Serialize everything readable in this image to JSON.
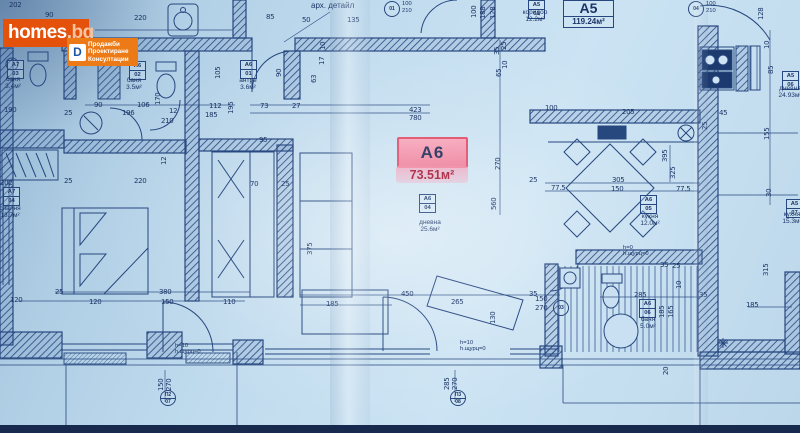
{
  "watermark": {
    "brand": "homes",
    "brand_suffix": ".bg",
    "emblem_letter": "D",
    "tagline_lines": [
      "Продажби",
      "Проектиране",
      "Консултации"
    ],
    "colors": {
      "brand_bg": "#e3510b",
      "tagline_bg": "#ec7b17",
      "text": "#ffffff",
      "suffix": "#f8c49f",
      "emblem_blue": "#1d56a8"
    }
  },
  "unit_a6": {
    "code": "А6",
    "area": "73.51м²",
    "highlight_bg": "#ee86a1",
    "highlight_border": "#e25672"
  },
  "unit_a5": {
    "code": "А5",
    "area": "119.24м²"
  },
  "plan": {
    "ink_color": "#27477f",
    "paper_color": "#c0dbee",
    "room_labels": [
      {
        "r1": "А7",
        "r2": "03",
        "bx": 7,
        "by": 60,
        "name": "баня",
        "area": "3.4м²",
        "tx": -4,
        "ty": 76,
        "tw": 34
      },
      {
        "r1": "А6",
        "r2": "02",
        "bx": 129,
        "by": 61,
        "name": "баня",
        "area": "3.5м²",
        "tx": 117,
        "ty": 77,
        "tw": 34
      },
      {
        "r1": "А6",
        "r2": "01",
        "bx": 240,
        "by": 60,
        "name": "антре",
        "area": "3.6м²",
        "tx": 229,
        "ty": 77,
        "tw": 38
      },
      {
        "r1": "А7",
        "r2": "04",
        "bx": 3,
        "by": 187,
        "name": "спалня",
        "area": "13.7м²",
        "tx": -8,
        "ty": 205,
        "tw": 36
      },
      {
        "r1": "А6",
        "r2": "04",
        "bx": 419,
        "by": 194,
        "name": "дневна",
        "area": "25.6м²",
        "tx": 408,
        "ty": 219,
        "tw": 44
      },
      {
        "r1": "А6",
        "r2": "05",
        "bx": 640,
        "by": 195,
        "name": "кухня",
        "area": "12.0м²",
        "tx": 628,
        "ty": 213,
        "tw": 44
      },
      {
        "r1": "А6",
        "r2": "06",
        "bx": 639,
        "by": 299,
        "name": "баня",
        "area": "5.0м²",
        "tx": 628,
        "ty": 316,
        "tw": 40
      },
      {
        "r1": "А5",
        "r2": "01",
        "bx": 528,
        "by": 0,
        "name": "коридор",
        "area": "12.2м²",
        "tx": 512,
        "ty": 9,
        "tw": 46
      },
      {
        "r1": "А5",
        "r2": "06",
        "bx": 782,
        "by": 71,
        "name": "дневна",
        "area": "24.93м²",
        "tx": 768,
        "ty": 85,
        "tw": 44
      },
      {
        "r1": "А5",
        "r2": "07",
        "bx": 786,
        "by": 199,
        "name": "кухня",
        "area": "15.3м²",
        "tx": 772,
        "ty": 211,
        "tw": 40
      }
    ],
    "notes": [
      {
        "lines": [
          "арх. детайл"
        ],
        "x": 311,
        "y": 3,
        "fs": 8
      },
      {
        "lines": [
          "h=10",
          "h.щурц=0"
        ],
        "x": 175,
        "y": 343
      },
      {
        "lines": [
          "h=10",
          "h.щурц=0"
        ],
        "x": 460,
        "y": 340
      },
      {
        "lines": [
          "h=0",
          "h.щурц=0"
        ],
        "x": 623,
        "y": 245
      }
    ],
    "markers": [
      {
        "c1": "01",
        "x": 384,
        "y": 1,
        "d1": "100",
        "d2": "210"
      },
      {
        "c1": "04",
        "x": 688,
        "y": 1,
        "d1": "100",
        "d2": "210"
      },
      {
        "c1": "П2",
        "c2": "07",
        "x": 160,
        "y": 390
      },
      {
        "c1": "П3",
        "c2": "08",
        "x": 450,
        "y": 390
      },
      {
        "c1": "03",
        "x": 553,
        "y": 300
      }
    ],
    "dims": [
      {
        "t": "202",
        "x": 9,
        "y": 1
      },
      {
        "t": "90",
        "x": 45,
        "y": 11
      },
      {
        "t": "220",
        "x": 134,
        "y": 14
      },
      {
        "t": "85",
        "x": 266,
        "y": 13
      },
      {
        "t": "50",
        "x": 302,
        "y": 16
      },
      {
        "t": "135",
        "x": 347,
        "y": 16
      },
      {
        "t": "100",
        "x": 470,
        "y": 1,
        "v": 1
      },
      {
        "t": "188",
        "x": 479,
        "y": 2,
        "v": 1
      },
      {
        "t": "128",
        "x": 489,
        "y": 2,
        "v": 1
      },
      {
        "t": "128",
        "x": 757,
        "y": 3,
        "v": 1
      },
      {
        "t": "190",
        "x": 4,
        "y": 106
      },
      {
        "t": "25",
        "x": 64,
        "y": 109
      },
      {
        "t": "90",
        "x": 94,
        "y": 101
      },
      {
        "t": "106",
        "x": 137,
        "y": 101
      },
      {
        "t": "196",
        "x": 122,
        "y": 109
      },
      {
        "t": "12",
        "x": 169,
        "y": 107
      },
      {
        "t": "210",
        "x": 161,
        "y": 117
      },
      {
        "t": "112",
        "x": 209,
        "y": 102
      },
      {
        "t": "185",
        "x": 205,
        "y": 111
      },
      {
        "t": "73",
        "x": 260,
        "y": 102
      },
      {
        "t": "27",
        "x": 292,
        "y": 102
      },
      {
        "t": "423",
        "x": 409,
        "y": 106
      },
      {
        "t": "780",
        "x": 409,
        "y": 114
      },
      {
        "t": "105",
        "x": 214,
        "y": 62,
        "v": 1
      },
      {
        "t": "170",
        "x": 154,
        "y": 88,
        "v": 1
      },
      {
        "t": "195",
        "x": 227,
        "y": 97,
        "v": 1
      },
      {
        "t": "90",
        "x": 275,
        "y": 64,
        "v": 1
      },
      {
        "t": "10",
        "x": 319,
        "y": 37,
        "v": 1
      },
      {
        "t": "17",
        "x": 318,
        "y": 52,
        "v": 1
      },
      {
        "t": "63",
        "x": 310,
        "y": 70,
        "v": 1
      },
      {
        "t": "35",
        "x": 493,
        "y": 42,
        "v": 1
      },
      {
        "t": "25",
        "x": 500,
        "y": 37,
        "v": 1
      },
      {
        "t": "65",
        "x": 495,
        "y": 64,
        "v": 1
      },
      {
        "t": "10",
        "x": 501,
        "y": 56,
        "v": 1
      },
      {
        "t": "100",
        "x": 545,
        "y": 104
      },
      {
        "t": "25",
        "x": 64,
        "y": 177
      },
      {
        "t": "220",
        "x": 134,
        "y": 177
      },
      {
        "t": "12",
        "x": 160,
        "y": 152,
        "v": 1
      },
      {
        "t": "202",
        "x": 0,
        "y": 179
      },
      {
        "t": "95",
        "x": 259,
        "y": 136
      },
      {
        "t": "70",
        "x": 250,
        "y": 180
      },
      {
        "t": "25",
        "x": 281,
        "y": 180
      },
      {
        "t": "375",
        "x": 306,
        "y": 238,
        "v": 1
      },
      {
        "t": "270",
        "x": 494,
        "y": 153,
        "v": 1
      },
      {
        "t": "560",
        "x": 490,
        "y": 193,
        "v": 1
      },
      {
        "t": "205",
        "x": 622,
        "y": 108
      },
      {
        "t": "305",
        "x": 612,
        "y": 176
      },
      {
        "t": "77.5",
        "x": 551,
        "y": 184
      },
      {
        "t": "150",
        "x": 611,
        "y": 185
      },
      {
        "t": "77.5",
        "x": 676,
        "y": 185
      },
      {
        "t": "395",
        "x": 661,
        "y": 145,
        "v": 1
      },
      {
        "t": "325",
        "x": 669,
        "y": 162,
        "v": 1
      },
      {
        "t": "25",
        "x": 529,
        "y": 176
      },
      {
        "t": "45",
        "x": 719,
        "y": 109
      },
      {
        "t": "25",
        "x": 701,
        "y": 117,
        "v": 1
      },
      {
        "t": "10",
        "x": 763,
        "y": 36,
        "v": 1
      },
      {
        "t": "85",
        "x": 767,
        "y": 61,
        "v": 1
      },
      {
        "t": "155",
        "x": 763,
        "y": 123,
        "v": 1
      },
      {
        "t": "30",
        "x": 765,
        "y": 184,
        "v": 1
      },
      {
        "t": "35",
        "x": 660,
        "y": 261
      },
      {
        "t": "25",
        "x": 672,
        "y": 262
      },
      {
        "t": "10",
        "x": 675,
        "y": 276,
        "v": 1
      },
      {
        "t": "285",
        "x": 634,
        "y": 291
      },
      {
        "t": "185",
        "x": 658,
        "y": 301,
        "v": 1
      },
      {
        "t": "165",
        "x": 667,
        "y": 301,
        "v": 1
      },
      {
        "t": "315",
        "x": 762,
        "y": 259,
        "v": 1
      },
      {
        "t": "185",
        "x": 746,
        "y": 301
      },
      {
        "t": "35",
        "x": 699,
        "y": 291
      },
      {
        "t": "20",
        "x": 662,
        "y": 362,
        "v": 1
      },
      {
        "t": "25",
        "x": 55,
        "y": 288
      },
      {
        "t": "380",
        "x": 159,
        "y": 288
      },
      {
        "t": "120",
        "x": 89,
        "y": 298
      },
      {
        "t": "150",
        "x": 161,
        "y": 298
      },
      {
        "t": "110",
        "x": 223,
        "y": 298
      },
      {
        "t": "120",
        "x": 10,
        "y": 296
      },
      {
        "t": "450",
        "x": 401,
        "y": 290
      },
      {
        "t": "265",
        "x": 451,
        "y": 298
      },
      {
        "t": "185",
        "x": 326,
        "y": 300
      },
      {
        "t": "130",
        "x": 489,
        "y": 307,
        "v": 1
      },
      {
        "t": "35",
        "x": 529,
        "y": 290
      },
      {
        "t": "150",
        "x": 535,
        "y": 295
      },
      {
        "t": "270",
        "x": 535,
        "y": 304
      },
      {
        "t": "150",
        "x": 157,
        "y": 374,
        "v": 1
      },
      {
        "t": "270",
        "x": 165,
        "y": 374,
        "v": 1
      },
      {
        "t": "285",
        "x": 443,
        "y": 373,
        "v": 1
      },
      {
        "t": "270",
        "x": 451,
        "y": 373,
        "v": 1
      }
    ]
  }
}
